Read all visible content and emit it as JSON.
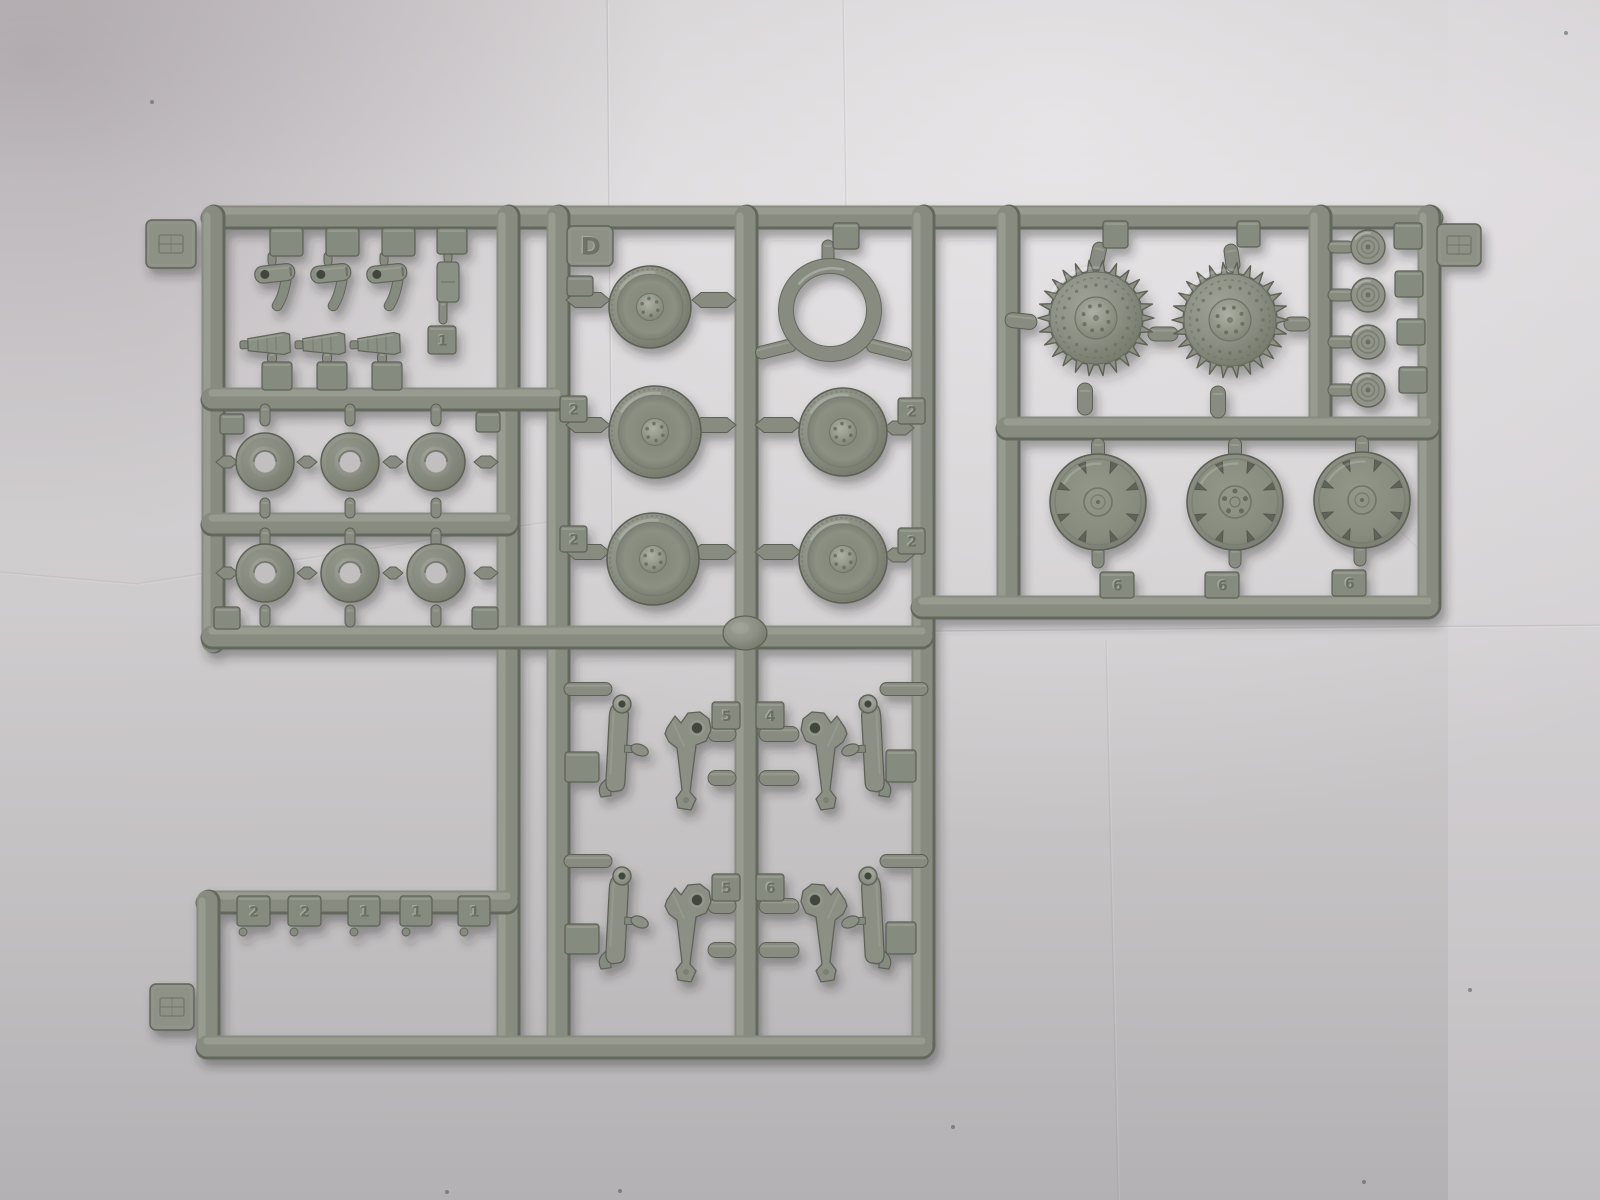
{
  "scene": {
    "description": "Photograph of a light gray injection-molded plastic model kit sprue (parts tree D) with tank running gear parts on creased white paper",
    "colors": {
      "paper_top": "#d8d5d7",
      "paper_base": "#cdc9cb",
      "paper_bottom": "#b3b1b3",
      "paper_bright": "#eceaec",
      "paper_shadow_corner": "#8c8489",
      "plastic_base": "#878b80",
      "plastic_light": "#a6a99e",
      "plastic_highlight": "#b8bab1",
      "plastic_dark": "#63675c",
      "plastic_outline": "#5c6055",
      "plastic_hole": "#42463e",
      "paper_through_hole": "#c2bfc1"
    }
  },
  "sprue": {
    "sprue_letter": "D",
    "embossed_labels": {
      "letter_tab": "D",
      "road_wheel_tags": [
        "2",
        "2",
        "2",
        "2"
      ],
      "hub_cover_tags": [
        "6",
        "6",
        "6"
      ],
      "arm_tags_row1": [
        "5",
        "4"
      ],
      "arm_tags_row2": [
        "5",
        "6"
      ],
      "strip_tags": [
        "2",
        "2",
        "1",
        "1",
        "1"
      ],
      "single_tag": "1"
    },
    "runners": [
      [
        212,
        216,
        1432,
        216
      ],
      [
        212,
        216,
        212,
        642
      ],
      [
        507,
        216,
        507,
        1046
      ],
      [
        557,
        216,
        557,
        1046
      ],
      [
        745,
        216,
        745,
        1046
      ],
      [
        922,
        216,
        922,
        1046
      ],
      [
        1007,
        216,
        1007,
        606
      ],
      [
        1319,
        216,
        1319,
        427
      ],
      [
        1428,
        216,
        1428,
        606
      ],
      [
        212,
        398,
        557,
        398
      ],
      [
        212,
        523,
        507,
        523
      ],
      [
        212,
        636,
        922,
        636
      ],
      [
        1007,
        427,
        1428,
        427
      ],
      [
        922,
        606,
        1428,
        606
      ],
      [
        207,
        901,
        507,
        901
      ],
      [
        207,
        901,
        207,
        1046
      ],
      [
        207,
        1046,
        922,
        1046
      ]
    ],
    "pills": [
      [
        1098,
        256,
        14,
        28,
        12
      ],
      [
        1232,
        258,
        14,
        28,
        -8
      ],
      [
        1085,
        399,
        15,
        32,
        0
      ],
      [
        1218,
        402,
        15,
        32,
        0
      ],
      [
        1021,
        321,
        32,
        15,
        6
      ],
      [
        1163,
        334,
        30,
        14,
        0
      ],
      [
        1297,
        324,
        26,
        14,
        0
      ],
      [
        828,
        252,
        12,
        24,
        0
      ],
      [
        776,
        349,
        42,
        13,
        -14
      ],
      [
        889,
        350,
        46,
        13,
        14
      ],
      [
        1341,
        247,
        26,
        12,
        0
      ],
      [
        1341,
        295,
        26,
        12,
        0
      ],
      [
        1341,
        342,
        26,
        12,
        0
      ],
      [
        1341,
        390,
        26,
        12,
        0
      ],
      [
        1098,
        452,
        13,
        28,
        0
      ],
      [
        1235,
        452,
        13,
        28,
        0
      ],
      [
        1362,
        450,
        13,
        28,
        0
      ],
      [
        1098,
        557,
        12,
        22,
        0
      ],
      [
        1235,
        557,
        12,
        22,
        0
      ],
      [
        1360,
        555,
        12,
        22,
        0
      ],
      [
        265,
        415,
        10,
        22,
        0
      ],
      [
        350,
        415,
        10,
        22,
        0
      ],
      [
        436,
        415,
        10,
        22,
        0
      ],
      [
        265,
        508,
        10,
        20,
        0
      ],
      [
        350,
        508,
        10,
        20,
        0
      ],
      [
        436,
        508,
        10,
        20,
        0
      ],
      [
        265,
        538,
        10,
        20,
        0
      ],
      [
        350,
        538,
        10,
        20,
        0
      ],
      [
        436,
        538,
        10,
        20,
        0
      ],
      [
        265,
        616,
        10,
        22,
        0
      ],
      [
        350,
        616,
        10,
        22,
        0
      ],
      [
        436,
        616,
        10,
        22,
        0
      ],
      [
        272,
        259,
        8,
        14,
        0
      ],
      [
        328,
        259,
        8,
        14,
        0
      ],
      [
        384,
        259,
        8,
        14,
        0
      ],
      [
        448,
        257,
        8,
        12,
        0
      ],
      [
        443,
        311,
        8,
        26,
        0
      ],
      [
        272,
        358,
        9,
        12,
        0
      ],
      [
        327,
        358,
        9,
        12,
        0
      ],
      [
        382,
        358,
        9,
        12,
        0
      ],
      [
        588,
        689,
        48,
        13,
        0
      ],
      [
        904,
        689,
        48,
        13,
        0
      ],
      [
        588,
        861,
        48,
        13,
        0
      ],
      [
        904,
        861,
        48,
        13,
        0
      ],
      [
        722,
        734,
        28,
        15,
        0
      ],
      [
        722,
        778,
        28,
        15,
        0
      ],
      [
        779,
        734,
        40,
        15,
        0
      ],
      [
        779,
        778,
        40,
        15,
        0
      ],
      [
        722,
        906,
        28,
        15,
        0
      ],
      [
        722,
        950,
        28,
        15,
        0
      ],
      [
        779,
        906,
        40,
        15,
        0
      ],
      [
        779,
        950,
        40,
        15,
        0
      ]
    ],
    "pointed_connectors": [
      [
        588,
        300,
        44,
        15
      ],
      [
        714,
        300,
        44,
        15
      ],
      [
        588,
        425,
        44,
        15
      ],
      [
        714,
        425,
        44,
        15
      ],
      [
        588,
        552,
        44,
        15
      ],
      [
        714,
        552,
        44,
        15
      ],
      [
        778,
        425,
        46,
        15
      ],
      [
        899,
        428,
        30,
        14
      ],
      [
        778,
        552,
        46,
        15
      ],
      [
        899,
        555,
        30,
        14
      ],
      [
        307,
        462,
        20,
        12
      ],
      [
        393,
        462,
        20,
        12
      ],
      [
        307,
        573,
        20,
        12
      ],
      [
        393,
        573,
        20,
        12
      ],
      [
        227,
        462,
        22,
        12
      ],
      [
        486,
        462,
        24,
        12
      ],
      [
        227,
        573,
        22,
        12
      ],
      [
        486,
        573,
        24,
        12
      ]
    ],
    "gates": [
      [
        270,
        228,
        33,
        28
      ],
      [
        326,
        228,
        33,
        28
      ],
      [
        382,
        228,
        33,
        28
      ],
      [
        437,
        228,
        30,
        26
      ],
      [
        262,
        362,
        30,
        28
      ],
      [
        317,
        362,
        30,
        28
      ],
      [
        372,
        362,
        30,
        28
      ],
      [
        567,
        276,
        26,
        20
      ],
      [
        833,
        223,
        26,
        26
      ],
      [
        1103,
        221,
        25,
        27
      ],
      [
        1237,
        221,
        23,
        26
      ],
      [
        1394,
        223,
        28,
        26
      ],
      [
        1395,
        271,
        28,
        26
      ],
      [
        1397,
        319,
        28,
        26
      ],
      [
        1399,
        367,
        28,
        26
      ],
      [
        220,
        414,
        24,
        20
      ],
      [
        476,
        412,
        24,
        20
      ],
      [
        214,
        607,
        26,
        22
      ],
      [
        472,
        607,
        26,
        22
      ],
      [
        565,
        752,
        34,
        30
      ],
      [
        886,
        750,
        30,
        32
      ],
      [
        565,
        924,
        34,
        30
      ],
      [
        886,
        922,
        30,
        32
      ]
    ],
    "number_tags": [
      [
        "2",
        560,
        396,
        27,
        26
      ],
      [
        "2",
        560,
        526,
        27,
        26
      ],
      [
        "2",
        898,
        398,
        27,
        26
      ],
      [
        "2",
        898,
        528,
        27,
        26
      ],
      [
        "6",
        1100,
        572,
        34,
        26
      ],
      [
        "6",
        1205,
        572,
        34,
        26
      ],
      [
        "6",
        1332,
        570,
        34,
        26
      ],
      [
        "5",
        712,
        702,
        28,
        27
      ],
      [
        "4",
        756,
        702,
        28,
        27
      ],
      [
        "5",
        712,
        874,
        28,
        27
      ],
      [
        "6",
        756,
        874,
        28,
        27
      ],
      [
        "2",
        237,
        896,
        33,
        30
      ],
      [
        "2",
        288,
        896,
        33,
        30
      ],
      [
        "1",
        348,
        896,
        32,
        30
      ],
      [
        "1",
        400,
        896,
        32,
        30
      ],
      [
        "1",
        458,
        896,
        32,
        30
      ],
      [
        "1",
        428,
        326,
        28,
        28
      ]
    ],
    "mold_tabs": [
      [
        146,
        220,
        50,
        48,
        "logo"
      ],
      [
        567,
        226,
        46,
        40,
        "D"
      ],
      [
        1437,
        224,
        44,
        42,
        "logo"
      ],
      [
        150,
        984,
        44,
        46,
        "logo"
      ]
    ],
    "parts": {
      "road_wheels": [
        [
          650,
          307,
          41
        ],
        [
          655,
          432,
          46
        ],
        [
          653,
          559,
          46
        ],
        [
          843,
          432,
          44
        ],
        [
          843,
          559,
          44
        ]
      ],
      "tire_ring": [
        830,
        310,
        44,
        7
      ],
      "drive_sprockets": [
        [
          1096,
          318
        ],
        [
          1230,
          320
        ]
      ],
      "sprocket_geometry": {
        "tip_radius": 58,
        "root_radius": 47,
        "teeth": 26
      },
      "donut_wheels": [
        [
          265,
          462
        ],
        [
          350,
          462
        ],
        [
          436,
          462
        ],
        [
          265,
          573
        ],
        [
          350,
          573
        ],
        [
          436,
          573
        ]
      ],
      "donut_geometry": {
        "outer_radius": 29,
        "hole_radius": 11
      },
      "return_rollers": [
        [
          1368,
          247
        ],
        [
          1368,
          295
        ],
        [
          1368,
          342
        ],
        [
          1368,
          390
        ]
      ],
      "roller_radius": 17,
      "hub_covers": [
        [
          1098,
          502,
          "rings"
        ],
        [
          1235,
          502,
          "bolts"
        ],
        [
          1362,
          500,
          "rings"
        ]
      ],
      "hub_radius": 48,
      "clamps": [
        [
          254,
          267
        ],
        [
          310,
          267
        ],
        [
          366,
          267
        ]
      ],
      "small_block": [
        437,
        262,
        22,
        40
      ],
      "cones": [
        [
          240,
          345
        ],
        [
          295,
          345
        ],
        [
          350,
          345
        ]
      ],
      "arm_rows": [
        704,
        876
      ],
      "injection_junction": [
        745,
        633
      ],
      "strip_tag_drips": [
        [
          243,
          932
        ],
        [
          294,
          932
        ],
        [
          354,
          932
        ],
        [
          406,
          932
        ],
        [
          464,
          932
        ]
      ]
    }
  },
  "photo": {
    "creases": [
      [
        607,
        0,
        612,
        545,
        0.16
      ],
      [
        843,
        0,
        846,
        212,
        0.12
      ],
      [
        930,
        631,
        1600,
        625,
        0.14
      ],
      [
        140,
        583,
        560,
        520,
        0.1
      ],
      [
        1106,
        640,
        1118,
        1200,
        0.1
      ],
      [
        1357,
        487,
        1437,
        568,
        0.18
      ],
      [
        0,
        572,
        140,
        584,
        0.1
      ]
    ],
    "specks": [
      [
        152,
        102
      ],
      [
        620,
        1191
      ],
      [
        953,
        1127
      ],
      [
        1470,
        990
      ],
      [
        1566,
        33
      ],
      [
        447,
        1192
      ],
      [
        1364,
        1182
      ]
    ]
  }
}
